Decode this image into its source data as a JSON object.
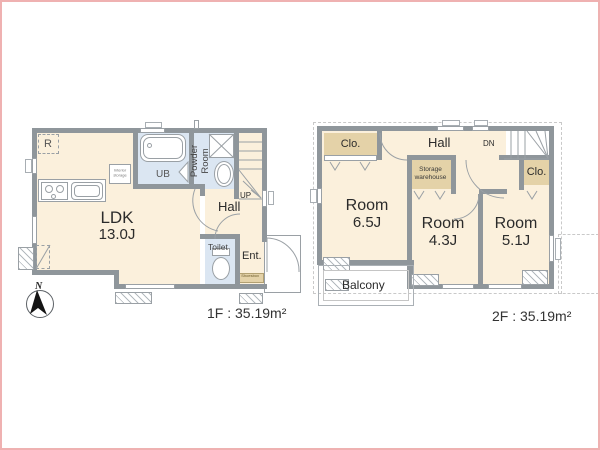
{
  "colors": {
    "wall": "#8f969b",
    "room_cream": "#fbf0dc",
    "wet_area_blue": "#dbe6f2",
    "closet_tan": "#e4d2a8",
    "frame_pink": "#efb1b1"
  },
  "floor1": {
    "caption": "1F : 35.19m²",
    "ldk": {
      "name": "LDK",
      "area": "13.0J"
    },
    "hall": "Hall",
    "ub": "UB",
    "powder_room": "Powder Room",
    "toilet": "Toilet",
    "entrance": "Ent.",
    "shoesbox": "Shoesbox",
    "refrigerator": "R",
    "stairs": "UP",
    "storage_note": "Interior storage"
  },
  "floor2": {
    "caption": "2F : 35.19m²",
    "room_a": {
      "name": "Room",
      "area": "6.5J"
    },
    "room_b": {
      "name": "Room",
      "area": "4.3J"
    },
    "room_c": {
      "name": "Room",
      "area": "5.1J"
    },
    "hall": "Hall",
    "closet_a": "Clo.",
    "closet_b": "Clo.",
    "storage": {
      "line1": "Storage",
      "line2": "warehouse"
    },
    "balcony": "Balcony",
    "stairs": "DN"
  },
  "compass": {
    "north": "N"
  }
}
